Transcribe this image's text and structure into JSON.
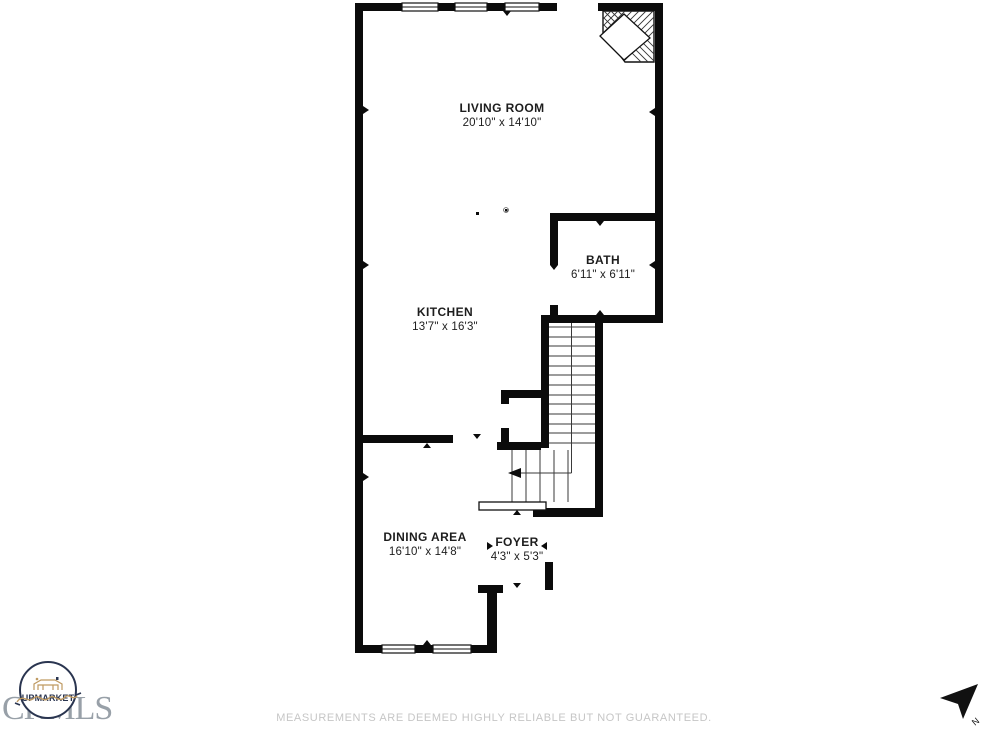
{
  "floor_plan": {
    "rooms": [
      {
        "name": "LIVING ROOM",
        "dimensions": "20'10\" x 14'10\""
      },
      {
        "name": "BATH",
        "dimensions": "6'11\" x 6'11\""
      },
      {
        "name": "KITCHEN",
        "dimensions": "13'7\" x 16'3\""
      },
      {
        "name": "DINING AREA",
        "dimensions": "16'10\" x 14'8\""
      },
      {
        "name": "FOYER",
        "dimensions": "4'3\" x 5'3\""
      }
    ],
    "features": [
      "corner-fireplace",
      "switchback-staircase",
      "under-stair-closet",
      "windows"
    ]
  },
  "footer": {
    "disclaimer": "MEASUREMENTS ARE DEEMED HIGHLY RELIABLE BUT NOT GUARANTEED."
  },
  "branding": {
    "logo_text": "UPMARKET",
    "watermark_text": "CRMLS"
  },
  "compass": {
    "north_label": "N"
  },
  "colors": {
    "wall": "#0b0b0b",
    "room_label": "#1d1d1d",
    "disclaimer_text": "#c6c6c6",
    "watermark": "#98a0a8",
    "logo_navy": "#2a3550",
    "logo_tan": "#bf9a62"
  }
}
